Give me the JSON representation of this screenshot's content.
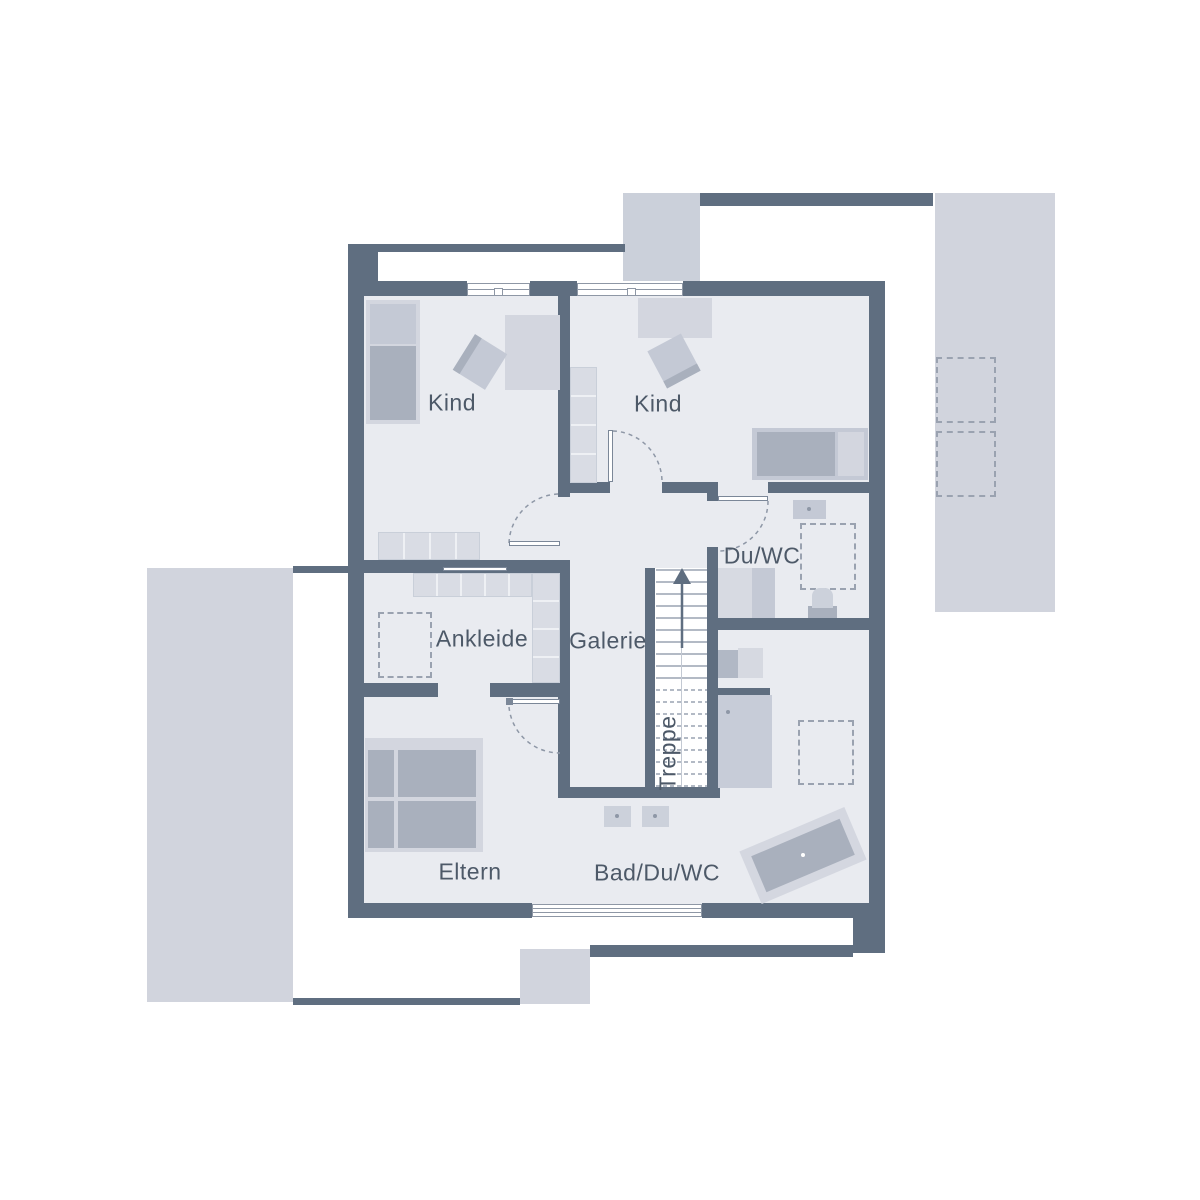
{
  "plan": {
    "type": "floor-plan",
    "language": "de",
    "rooms": [
      {
        "id": "kind-1",
        "label": "Kind"
      },
      {
        "id": "kind-2",
        "label": "Kind"
      },
      {
        "id": "du-wc",
        "label": "Du/WC"
      },
      {
        "id": "ankleide",
        "label": "Ankleide"
      },
      {
        "id": "galerie",
        "label": "Galerie"
      },
      {
        "id": "treppe",
        "label": "Treppe"
      },
      {
        "id": "eltern",
        "label": "Eltern"
      },
      {
        "id": "bad-du-wc",
        "label": "Bad/Du/WC"
      }
    ],
    "features": [
      "stairs-with-up-arrow",
      "door-swing-arcs",
      "windows",
      "terraces",
      "bathtub",
      "shower",
      "beds",
      "wardrobes"
    ],
    "colors": {
      "wall": "#5f6e80",
      "floor": "#e9ebf0",
      "terrace": "#d1d4dd",
      "furniture_light": "#d3d6df",
      "furniture_medium": "#c4c9d5",
      "furniture_dark": "#a9b0bd",
      "text": "#4d5968",
      "dash": "#8e97a6"
    }
  }
}
